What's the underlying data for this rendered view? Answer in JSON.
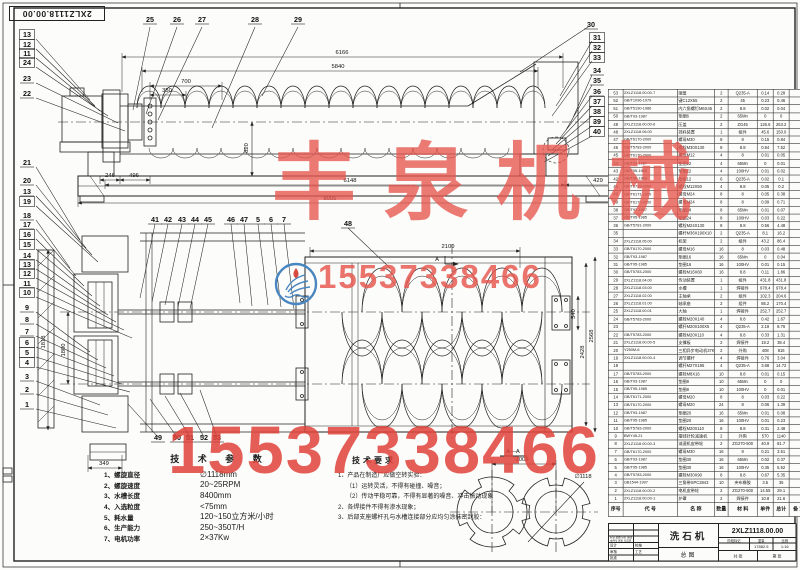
{
  "sheet": {
    "corner_label": "2XLZ1118.00.00"
  },
  "watermarks": {
    "company": "丰泉机械",
    "phone_middle": "15537338466",
    "phone_bottom": "15537338466",
    "red_color": "#e5544d",
    "logo_blue": "#4a86c0"
  },
  "tech_params": {
    "title": "技 术 参 数",
    "items": [
      {
        "label": "1、螺旋直径",
        "value": "∅1118mm"
      },
      {
        "label": "2、螺旋速度",
        "value": "20~25RPM"
      },
      {
        "label": "3、水槽长度",
        "value": "8400mm"
      },
      {
        "label": "4、入选粒度",
        "value": "<75mm"
      },
      {
        "label": "5、耗水量",
        "value": "120~150立方米/小时"
      },
      {
        "label": "6、生产能力",
        "value": "250~350T/H"
      },
      {
        "label": "7、电机功率",
        "value": "2×37Kw"
      }
    ]
  },
  "tech_req": {
    "title": "技术要求",
    "lines": [
      {
        "text": "1、产品在制造厂应做空转实验：",
        "indent": false
      },
      {
        "text": "（1）运转灵活，不得有碰撞、噪音；",
        "indent": true
      },
      {
        "text": "（2）传动平稳可靠，不得有显著的噪音、冲击振动现象",
        "indent": true
      },
      {
        "text": "2、各焊接件不得有渗水现象；",
        "indent": false
      },
      {
        "text": "3、后部支座螺杆孔与水槽连接部分应均匀涂抹密封胶：",
        "indent": false
      }
    ]
  },
  "bom": {
    "headers": [
      "序号",
      "代  号",
      "名  称",
      "数量",
      "材  料",
      "单件",
      "总计",
      "备 注"
    ],
    "rows": [
      [
        "53",
        "2XLZ1118.00.00-7",
        "端盖",
        "2",
        "Q235-A",
        "0.14",
        "0.28",
        ""
      ],
      [
        "52",
        "GB/T1096-1979",
        "键C12X55",
        "2",
        "45",
        "0.23",
        "0.46",
        ""
      ],
      [
        "51",
        "GB/T5190-1986",
        "内六角螺钉M6X45",
        "2",
        "8.8",
        "0.02",
        "0.04",
        ""
      ],
      [
        "50",
        "GB/T93-1987",
        "垫圈6",
        "2",
        "65Mn",
        "0",
        "0",
        ""
      ],
      [
        "49",
        "2XLZ1118.00.00-6",
        "压盖",
        "2",
        "ZG45",
        "126.6",
        "253.2",
        ""
      ],
      [
        "48",
        "2XLZ1118.06.00",
        "挡料装置",
        "1",
        "组件",
        "45.6",
        "150.0",
        ""
      ],
      [
        "47",
        "GB/T6170-2000",
        "螺母M30",
        "8",
        "8",
        "0.15",
        "0.84",
        ""
      ],
      [
        "46",
        "GB/T5783-2000",
        "螺栓M30X130",
        "8",
        "8.8",
        "0.94",
        "7.52",
        ""
      ],
      [
        "45",
        "GB/T6170-2000",
        "螺母M12",
        "4",
        "8",
        "0.01",
        "0.05",
        ""
      ],
      [
        "44",
        "GB/T93-1987",
        "垫圈12",
        "4",
        "65Mn",
        "0",
        "0.01",
        ""
      ],
      [
        "43",
        "GB/T95-1985",
        "垫圈12",
        "4",
        "100HV",
        "0.01",
        "0.02",
        ""
      ],
      [
        "42",
        "GB/T96-1988",
        "垫圈12",
        "6",
        "Q235-A",
        "0.02",
        "0.1",
        ""
      ],
      [
        "41",
        "GB/T5783-2000",
        "螺栓M12X50",
        "4",
        "8.8",
        "0.05",
        "0.2",
        ""
      ],
      [
        "40",
        "GB/T6171-2000",
        "螺母M24",
        "8",
        "8",
        "0.05",
        "0.38",
        ""
      ],
      [
        "39",
        "GB/T6170-2000",
        "螺母M24",
        "8",
        "8",
        "0.09",
        "0.71",
        ""
      ],
      [
        "38",
        "GB/T93-1987",
        "垫圈24",
        "8",
        "65Mn",
        "0.01",
        "0.07",
        ""
      ],
      [
        "37",
        "GB/T95-1985",
        "垫圈24",
        "8",
        "100HV",
        "0.03",
        "0.22",
        ""
      ],
      [
        "36",
        "GB/T5781-2000",
        "螺栓M24X130",
        "8",
        "8.8",
        "0.56",
        "4.48",
        ""
      ],
      [
        "35",
        "",
        "螺杆M36X190X10",
        "2",
        "Q235-A",
        "8.1",
        "16.2",
        ""
      ],
      [
        "34",
        "2XLZ1118.05.00",
        "机架",
        "2",
        "组件",
        "43.2",
        "86.4",
        ""
      ],
      [
        "33",
        "GB/T6170-2000",
        "螺母M16",
        "16",
        "8",
        "0.03",
        "0.48",
        ""
      ],
      [
        "32",
        "GB/T93-1987",
        "垫圈16",
        "16",
        "65Mn",
        "0",
        "0.04",
        ""
      ],
      [
        "31",
        "GB/T95-1985",
        "垫圈16",
        "16",
        "100HV",
        "0.01",
        "0.15",
        ""
      ],
      [
        "30",
        "GB/T5783-2000",
        "螺栓M16X60",
        "16",
        "8.8",
        "0.11",
        "1.86",
        ""
      ],
      [
        "29",
        "2XLZ1118.04.00",
        "传动装置",
        "1",
        "组件",
        "431.8",
        "431.8",
        ""
      ],
      [
        "28",
        "2XLZ1118.03.00",
        "水槽",
        "1",
        "焊接件",
        "978.4",
        "978.4",
        ""
      ],
      [
        "27",
        "2XLZ1118.02.00",
        "主轴承",
        "2",
        "组件",
        "102.3",
        "204.6",
        ""
      ],
      [
        "26",
        "2XLZ1118.01.00",
        "轴承座",
        "2",
        "组件",
        "85.2",
        "170.4",
        ""
      ],
      [
        "25",
        "2XLZ1118.00.01",
        "大轴",
        "1",
        "焊接件",
        "252.7",
        "252.7",
        ""
      ],
      [
        "24",
        "GB/T5783-2000",
        "螺栓M20X140",
        "4",
        "8.8",
        "0.42",
        "1.67",
        ""
      ],
      [
        "23",
        "",
        "螺杆M20X100X5",
        "4",
        "Q235-A",
        "2.19",
        "8.76",
        ""
      ],
      [
        "22",
        "GB/T5783-2000",
        "螺栓M20X110",
        "4",
        "8.8",
        "0.33",
        "1.31",
        ""
      ],
      [
        "21",
        "2XLZ1118.00.00-5",
        "支撑板",
        "2",
        "焊接件",
        "19.2",
        "38.4",
        ""
      ],
      [
        "20",
        "Y250M-6",
        "三相异步电动机37KW",
        "2",
        "外购",
        "408",
        "816",
        ""
      ],
      [
        "19",
        "2XLZ1118.00.00-4",
        "调节螺杆",
        "4",
        "焊接件",
        "0.76",
        "3.04",
        ""
      ],
      [
        "18",
        "",
        "螺杆M27X185",
        "4",
        "Q235-A",
        "3.68",
        "14.72",
        ""
      ],
      [
        "17",
        "GB/T5783-2000",
        "螺栓M8X16",
        "10",
        "8.8",
        "0.01",
        "0.15",
        ""
      ],
      [
        "16",
        "GB/T93-1987",
        "垫圈8",
        "10",
        "65Mn",
        "0",
        "0",
        ""
      ],
      [
        "15",
        "GB/T95-1985",
        "垫圈8",
        "10",
        "100HV",
        "0",
        "0.01",
        ""
      ],
      [
        "14",
        "GB/T6171-2000",
        "螺母M20",
        "8",
        "8",
        "0.03",
        "0.22",
        ""
      ],
      [
        "13",
        "GB/T6170-2000",
        "螺母M20",
        "24",
        "8",
        "0.06",
        "1.39",
        ""
      ],
      [
        "12",
        "GB/T93-1987",
        "垫圈20",
        "16",
        "65Mn",
        "0.01",
        "0.08",
        ""
      ],
      [
        "11",
        "GB/T95-1985",
        "垫圈20",
        "16",
        "100HV",
        "0.01",
        "0.23",
        ""
      ],
      [
        "10",
        "GB/T5783-2000",
        "螺栓M20X110",
        "8",
        "8.8",
        "0.31",
        "2.48",
        ""
      ],
      [
        "9",
        "BWY45-21",
        "摆线针轮减速机",
        "2",
        "外购",
        "570",
        "1140",
        ""
      ],
      [
        "8",
        "2XLZ1118.00.00-3",
        "减速机皮带轮",
        "2",
        "ZG270-500",
        "40.9",
        "81.7",
        ""
      ],
      [
        "7",
        "GB/T6170-2000",
        "螺母M30",
        "16",
        "8",
        "0.21",
        "3.51",
        ""
      ],
      [
        "6",
        "GB/T93-1987",
        "垫圈30",
        "16",
        "65Mn",
        "0.02",
        "0.37",
        ""
      ],
      [
        "5",
        "GB/T95-1985",
        "垫圈30",
        "16",
        "100HV",
        "0.35",
        "5.52",
        ""
      ],
      [
        "4",
        "GB/T5783-2000",
        "螺栓M30X90",
        "8",
        "8.8",
        "0.67",
        "5.35",
        ""
      ],
      [
        "3",
        "GB1544-1997",
        "三角带SPC2843",
        "10",
        "夹布橡胶",
        "3.5",
        "35",
        ""
      ],
      [
        "2",
        "2XLZ1118.00.00-2",
        "电机皮带轮",
        "2",
        "ZG270-500",
        "14.55",
        "29.1",
        ""
      ],
      [
        "1",
        "2XLZ1118.00.00-1",
        "护罩",
        "2",
        "焊接件",
        "10.8",
        "21.6",
        ""
      ]
    ]
  },
  "title_block": {
    "product_name": "洗石机",
    "drawing_type": "总图",
    "drawing_no": "2XLZ1118.00.00",
    "stage_label": "阶段标记",
    "weight_label": "重量",
    "scale_label": "比例",
    "weight": "17882.5",
    "scale": "1:16",
    "sheets": "共  张",
    "sheet_no": "第  张",
    "rev_header": "标记 处数 分区 更改文件号 签名 年月日",
    "signers": [
      "设计",
      "校核",
      "审核",
      "工艺",
      "批准"
    ]
  },
  "balloons": [
    {
      "t": "25",
      "x": 150,
      "y": 22,
      "b": 0
    },
    {
      "t": "26",
      "x": 177,
      "y": 22,
      "b": 0
    },
    {
      "t": "27",
      "x": 202,
      "y": 22,
      "b": 0
    },
    {
      "t": "28",
      "x": 255,
      "y": 22,
      "b": 0
    },
    {
      "t": "29",
      "x": 298,
      "y": 22,
      "b": 0
    },
    {
      "t": "30",
      "x": 591,
      "y": 27,
      "b": 0
    },
    {
      "t": "31",
      "x": 597,
      "y": 40,
      "b": 1
    },
    {
      "t": "32",
      "x": 597,
      "y": 50,
      "b": 1
    },
    {
      "t": "33",
      "x": 597,
      "y": 60,
      "b": 1
    },
    {
      "t": "34",
      "x": 597,
      "y": 73,
      "b": 0
    },
    {
      "t": "35",
      "x": 597,
      "y": 83,
      "b": 0
    },
    {
      "t": "36",
      "x": 597,
      "y": 94,
      "b": 0
    },
    {
      "t": "37",
      "x": 597,
      "y": 104,
      "b": 1
    },
    {
      "t": "38",
      "x": 597,
      "y": 114,
      "b": 1
    },
    {
      "t": "39",
      "x": 597,
      "y": 124,
      "b": 1
    },
    {
      "t": "40",
      "x": 597,
      "y": 134,
      "b": 1
    },
    {
      "t": "13",
      "x": 27,
      "y": 37,
      "b": 1
    },
    {
      "t": "12",
      "x": 27,
      "y": 47,
      "b": 1
    },
    {
      "t": "11",
      "x": 27,
      "y": 56,
      "b": 1
    },
    {
      "t": "24",
      "x": 27,
      "y": 65,
      "b": 1
    },
    {
      "t": "23",
      "x": 27,
      "y": 81,
      "b": 0
    },
    {
      "t": "22",
      "x": 27,
      "y": 96,
      "b": 0
    },
    {
      "t": "21",
      "x": 27,
      "y": 165,
      "b": 0
    },
    {
      "t": "20",
      "x": 27,
      "y": 183,
      "b": 0
    },
    {
      "t": "13",
      "x": 27,
      "y": 194,
      "b": 0
    },
    {
      "t": "19",
      "x": 27,
      "y": 204,
      "b": 1
    },
    {
      "t": "18",
      "x": 27,
      "y": 218,
      "b": 0
    },
    {
      "t": "17",
      "x": 27,
      "y": 227,
      "b": 0
    },
    {
      "t": "16",
      "x": 27,
      "y": 237,
      "b": 1
    },
    {
      "t": "15",
      "x": 27,
      "y": 247,
      "b": 1
    },
    {
      "t": "14",
      "x": 27,
      "y": 258,
      "b": 0
    },
    {
      "t": "13",
      "x": 27,
      "y": 267,
      "b": 1
    },
    {
      "t": "12",
      "x": 27,
      "y": 276,
      "b": 1
    },
    {
      "t": "11",
      "x": 27,
      "y": 286,
      "b": 0
    },
    {
      "t": "10",
      "x": 27,
      "y": 295,
      "b": 1
    },
    {
      "t": "9",
      "x": 27,
      "y": 310,
      "b": 0
    },
    {
      "t": "8",
      "x": 27,
      "y": 322,
      "b": 0
    },
    {
      "t": "7",
      "x": 27,
      "y": 334,
      "b": 0
    },
    {
      "t": "6",
      "x": 27,
      "y": 345,
      "b": 1
    },
    {
      "t": "5",
      "x": 27,
      "y": 355,
      "b": 1
    },
    {
      "t": "4",
      "x": 27,
      "y": 365,
      "b": 1
    },
    {
      "t": "3",
      "x": 27,
      "y": 379,
      "b": 0
    },
    {
      "t": "2",
      "x": 27,
      "y": 392,
      "b": 0
    },
    {
      "t": "1",
      "x": 27,
      "y": 407,
      "b": 0
    },
    {
      "t": "41",
      "x": 155,
      "y": 222,
      "b": 0
    },
    {
      "t": "42",
      "x": 168,
      "y": 222,
      "b": 0
    },
    {
      "t": "43",
      "x": 182,
      "y": 222,
      "b": 0
    },
    {
      "t": "44",
      "x": 195,
      "y": 222,
      "b": 0
    },
    {
      "t": "45",
      "x": 208,
      "y": 222,
      "b": 0
    },
    {
      "t": "46",
      "x": 231,
      "y": 222,
      "b": 0
    },
    {
      "t": "47",
      "x": 244,
      "y": 222,
      "b": 0
    },
    {
      "t": "5",
      "x": 258,
      "y": 222,
      "b": 0
    },
    {
      "t": "6",
      "x": 271,
      "y": 222,
      "b": 0
    },
    {
      "t": "7",
      "x": 284,
      "y": 222,
      "b": 0
    },
    {
      "t": "48",
      "x": 348,
      "y": 226,
      "b": 0
    },
    {
      "t": "49",
      "x": 158,
      "y": 440,
      "b": 0
    },
    {
      "t": "50",
      "x": 177,
      "y": 440,
      "b": 0
    },
    {
      "t": "51",
      "x": 190,
      "y": 440,
      "b": 0
    },
    {
      "t": "52",
      "x": 204,
      "y": 440,
      "b": 0
    },
    {
      "t": "53",
      "x": 217,
      "y": 440,
      "b": 0
    }
  ],
  "dimensions": [
    {
      "t": "6166",
      "x": 342,
      "y": 54,
      "r": 0
    },
    {
      "t": "5840",
      "x": 338,
      "y": 68,
      "r": 0
    },
    {
      "t": "700",
      "x": 186,
      "y": 83,
      "r": 0
    },
    {
      "t": "350",
      "x": 167,
      "y": 92,
      "r": 0
    },
    {
      "t": "820",
      "x": 248,
      "y": 148,
      "r": -90
    },
    {
      "t": "246",
      "x": 110,
      "y": 177,
      "r": 0
    },
    {
      "t": "496",
      "x": 134,
      "y": 177,
      "r": 0
    },
    {
      "t": "6148",
      "x": 350,
      "y": 182,
      "r": 0
    },
    {
      "t": "429",
      "x": 598,
      "y": 182,
      "r": 0
    },
    {
      "t": "8005",
      "x": 330,
      "y": 200,
      "r": 0
    },
    {
      "t": "2100",
      "x": 448,
      "y": 248,
      "r": 0
    },
    {
      "t": "540",
      "x": 575,
      "y": 314,
      "r": -90
    },
    {
      "t": "2428",
      "x": 584,
      "y": 352,
      "r": -90
    },
    {
      "t": "2568",
      "x": 593,
      "y": 336,
      "r": -90
    },
    {
      "t": "1800",
      "x": 65,
      "y": 350,
      "r": -90
    },
    {
      "t": "1818",
      "x": 45,
      "y": 342,
      "r": -90
    },
    {
      "t": "349",
      "x": 104,
      "y": 465,
      "r": 0
    },
    {
      "t": "1009",
      "x": 522,
      "y": 461,
      "r": 0
    },
    {
      "t": "∅1118",
      "x": 583,
      "y": 478,
      "r": 0
    },
    {
      "t": "A",
      "x": 437,
      "y": 261,
      "r": 0
    },
    {
      "t": "A—A",
      "x": 513,
      "y": 453,
      "r": 0
    }
  ]
}
